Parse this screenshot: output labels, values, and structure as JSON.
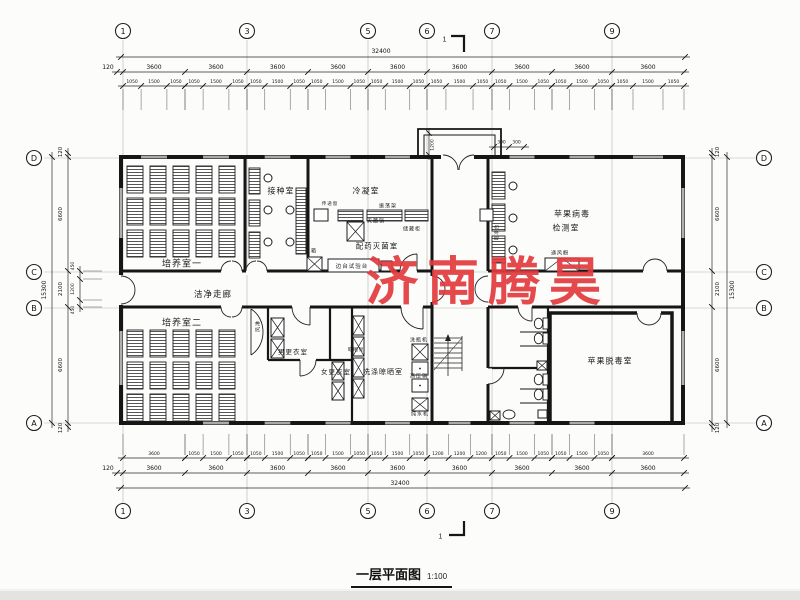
{
  "watermark": {
    "text": "济南腾昊",
    "color": "#e23a3e"
  },
  "title": {
    "text": "一层平面图",
    "scale": "1:100"
  },
  "grid": {
    "top": [
      "1",
      "3",
      "5",
      "6",
      "7",
      "9"
    ],
    "bottom": [
      "1",
      "3",
      "5",
      "6",
      "7",
      "9"
    ],
    "left": [
      "D",
      "C",
      "B",
      "A"
    ],
    "right": [
      "D",
      "C",
      "B",
      "A"
    ]
  },
  "section_mark": {
    "top": "1",
    "bottom": "1"
  },
  "dimensions": {
    "top": {
      "total": "32400",
      "axis": [
        "120",
        "3600",
        "3600",
        "3600",
        "3600",
        "3600",
        "3600",
        "3600",
        "3600",
        "3600"
      ],
      "fine": [
        "1050",
        "1500",
        "1050",
        "1050",
        "1500",
        "1050",
        "1050",
        "1500",
        "1050",
        "1050",
        "1500",
        "1050",
        "1050",
        "1500",
        "1050",
        "1050",
        "1500",
        "1050",
        "1050",
        "1500",
        "1050",
        "1050",
        "1500",
        "1050",
        "1050",
        "1500",
        "1050"
      ]
    },
    "bottom": {
      "total": "32400",
      "axis": [
        "120",
        "3600",
        "3600",
        "3600",
        "3600",
        "3600",
        "3600",
        "3600",
        "3600",
        "3600"
      ],
      "fine": [
        "3600",
        "1050",
        "1500",
        "1050",
        "1050",
        "1500",
        "1050",
        "1050",
        "1500",
        "1050",
        "1050",
        "1500",
        "1050",
        "1200",
        "1200",
        "1200",
        "1050",
        "1500",
        "1050",
        "1050",
        "1500",
        "1050",
        "3600"
      ]
    },
    "left": {
      "total": "15300",
      "axis": [
        "120",
        "6600",
        "2100",
        "6600",
        "120"
      ],
      "sub": [
        "450",
        "1200",
        "450"
      ]
    },
    "right": {
      "total": "15300",
      "axis": [
        "120",
        "6600",
        "2100",
        "6600",
        "120"
      ]
    },
    "entrance": {
      "depth": "1200",
      "left": "300",
      "right": "300"
    }
  },
  "labels": [
    {
      "n": "room-label-peiyangshi1",
      "t": "培养室一",
      "x": 182,
      "y": 263,
      "s": 9
    },
    {
      "n": "room-label-jiezhongshi",
      "t": "接种室",
      "x": 281,
      "y": 191,
      "s": 8
    },
    {
      "n": "room-label-lengningshi",
      "t": "冷凝室",
      "x": 366,
      "y": 191,
      "s": 8
    },
    {
      "n": "room-label-peiyaomiejunshi",
      "t": "配药灭菌室",
      "x": 377,
      "y": 246,
      "s": 7.5
    },
    {
      "n": "room-label-pingguobingdu",
      "t": "苹果病毒",
      "x": 572,
      "y": 214,
      "s": 8
    },
    {
      "n": "room-label-jianceshi",
      "t": "检测室",
      "x": 566,
      "y": 228,
      "s": 8
    },
    {
      "n": "corridor-label-jiejingzoulang",
      "t": "洁净走廊",
      "x": 213,
      "y": 294,
      "s": 8.5
    },
    {
      "n": "room-label-peiyangshi2",
      "t": "培养室二",
      "x": 182,
      "y": 322,
      "s": 9
    },
    {
      "n": "room-label-nangengyishi",
      "t": "男更衣室",
      "x": 293,
      "y": 351,
      "s": 6.5
    },
    {
      "n": "room-label-nvgengyishi",
      "t": "女更衣室",
      "x": 336,
      "y": 371,
      "s": 6.5
    },
    {
      "n": "room-label-xidiliangshaishi",
      "t": "洗涤晾晒室",
      "x": 383,
      "y": 372,
      "s": 7
    },
    {
      "n": "room-label-pingguotuodushi",
      "t": "苹果脱毒室",
      "x": 610,
      "y": 361,
      "s": 8
    },
    {
      "n": "equip-label-zhendangjia",
      "t": "振荡架",
      "x": 388,
      "y": 206,
      "s": 5
    },
    {
      "n": "equip-label-miejunguo",
      "t": "灭菌锅",
      "x": 376,
      "y": 221,
      "s": 5
    },
    {
      "n": "equip-label-chucanggui",
      "t": "储藏柜",
      "x": 412,
      "y": 229,
      "s": 5
    },
    {
      "n": "equip-label-biantaishiyantai",
      "t": "边台试验台",
      "x": 352,
      "y": 265.5,
      "s": 5.5
    },
    {
      "n": "equip-label-bingxiang",
      "t": "冰箱",
      "x": 311,
      "y": 251,
      "s": 5
    },
    {
      "n": "equip-label-chuandichuang",
      "t": "传递窗",
      "x": 330,
      "y": 204,
      "s": 4.5
    },
    {
      "n": "equip-label-chaojingtai",
      "t": "超净台",
      "x": 497,
      "y": 232,
      "s": 4.5,
      "r": 1
    },
    {
      "n": "equip-label-tongfengchu",
      "t": "通风橱",
      "x": 560,
      "y": 253,
      "s": 5
    },
    {
      "n": "equip-label-fenglin",
      "t": "风淋",
      "x": 258,
      "y": 326,
      "s": 5,
      "r": 1
    },
    {
      "n": "equip-label-xipingji",
      "t": "洗瓶机",
      "x": 419,
      "y": 340,
      "s": 5
    },
    {
      "n": "equip-label-gaoyaguo",
      "t": "高压锅",
      "x": 419,
      "y": 376,
      "s": 5
    },
    {
      "n": "equip-label-chunshuiji",
      "t": "纯水机",
      "x": 420,
      "y": 414,
      "s": 5
    },
    {
      "n": "equip-label-liangshaijia",
      "t": "晾晒架",
      "x": 356,
      "y": 350,
      "s": 4.5
    },
    {
      "n": "section-mark-top-label",
      "t": "1",
      "x": 445,
      "y": 40,
      "s": 7
    },
    {
      "n": "section-mark-bottom-label",
      "t": "1",
      "x": 441,
      "y": 537,
      "s": 7
    }
  ]
}
